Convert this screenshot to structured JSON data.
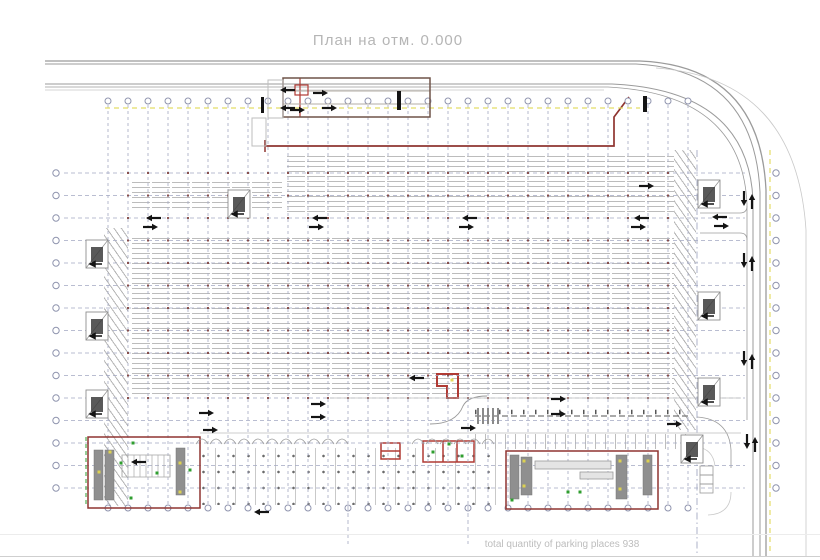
{
  "title": "План на отм. 0.000",
  "footer": "total quantity of parking places 938",
  "colors": {
    "grid": "#a3a8c2",
    "bubble": "#8f94ae",
    "road": "#9b9b9b",
    "road_faint": "#c9c9c9",
    "stall": "#bcbcbc",
    "red": "#8f3430",
    "red_bright": "#b03a34",
    "brown": "#6f5348",
    "yellow": "#e4dd67",
    "green": "#2f9e2f",
    "black": "#141414",
    "core": "#8f8f8f",
    "column_dot": "#7d3b36",
    "light": "#bdbdbd"
  },
  "plan": {
    "vgrid": {
      "x0": 108,
      "step": 20,
      "count": 30,
      "bubbleYTop": 101,
      "bubbleYBot": 508,
      "lineY0": 105,
      "lineY1": 504
    },
    "hgrid": {
      "y0": 173,
      "step": 22.5,
      "count": 15,
      "bubbleXLeft": 56,
      "bubbleXRight": 776,
      "lineX0": 64,
      "lineX1": 745
    },
    "fields": [
      {
        "x": 285,
        "y": 152,
        "w": 389,
        "h": 60,
        "t": "stalls"
      },
      {
        "x": 130,
        "y": 178,
        "w": 152,
        "h": 34,
        "t": "stalls"
      },
      {
        "x": 130,
        "y": 234,
        "w": 544,
        "h": 162,
        "t": "stalls"
      },
      {
        "x": 104,
        "y": 228,
        "w": 24,
        "h": 278,
        "t": "hatch"
      },
      {
        "x": 674,
        "y": 150,
        "w": 22,
        "h": 280,
        "t": "hatch"
      },
      {
        "x": 196,
        "y": 448,
        "w": 300,
        "h": 57,
        "t": "bike"
      },
      {
        "x": 475,
        "y": 434,
        "w": 213,
        "h": 15,
        "t": "vlines"
      }
    ],
    "paths": [
      {
        "d": "M45,61 H640 Q760,66 766,190 V556",
        "c": "#9b9b9b",
        "w": 1.3
      },
      {
        "d": "M45,64 H636 Q754,70 760,192 V556",
        "c": "#9b9b9b",
        "w": 1
      },
      {
        "d": "M45,84 H612 Q748,90 753,200 V556",
        "c": "#9b9b9b",
        "w": 1
      },
      {
        "d": "M45,87 H608 Q742,94 747,204 V420",
        "c": "#9b9b9b",
        "w": 0.8
      },
      {
        "d": "M45,90 H604",
        "c": "#c9c9c9",
        "w": 0.8
      },
      {
        "d": "M656,68 Q796,78 806,230 V556",
        "c": "#c9c9c9",
        "w": 0.8
      },
      {
        "d": "M697,417 Q729,419 731,450 V468",
        "c": "#9b9b9b",
        "w": 0.8
      },
      {
        "d": "M697,447 Q713,449 715,466",
        "c": "#c9c9c9",
        "w": 0.8
      },
      {
        "d": "M731,492 Q731,514 708,515",
        "c": "#c9c9c9",
        "w": 0.8
      },
      {
        "d": "M740,213 Q747,213 747,206",
        "c": "#9b9b9b",
        "w": 0.8
      },
      {
        "d": "M740,233 Q747,233 747,240",
        "c": "#9b9b9b",
        "w": 0.8
      },
      {
        "d": "M430,424 Q456,424 463,406 Q468,396 487,396",
        "c": "#999999",
        "w": 0.9
      },
      {
        "d": "M265,146 H614 V117 L629,97",
        "c": "#8f3430",
        "w": 1.7
      },
      {
        "d": "M265,140 V152",
        "c": "#8f3430",
        "w": 1.5
      },
      {
        "d": "M300,78 V117",
        "c": "#b03a34",
        "w": 1.2
      },
      {
        "d": "M437,374 h21 v24 h-11 v-12 h-10 z",
        "c": "#b03a34",
        "w": 2
      },
      {
        "d": "M423,441 h51 v21 h-51 z M443,441 v21 M457,441 v21",
        "c": "#b03a34",
        "w": 1.5
      },
      {
        "d": "M381,443 h19 v16 h-19 z M381,451 h19",
        "c": "#b03a34",
        "w": 1.5
      }
    ],
    "lines": [
      [
        700,
        213,
        740,
        213,
        "#9b9b9b",
        0.8,
        ""
      ],
      [
        700,
        233,
        740,
        233,
        "#9b9b9b",
        0.8,
        ""
      ],
      [
        330,
        398,
        741,
        398,
        "#bdbdbd",
        0.8,
        ""
      ],
      [
        200,
        433,
        741,
        433,
        "#bdbdbd",
        0.8,
        ""
      ],
      [
        283,
        91,
        430,
        91,
        "#b3aca4",
        0.9,
        ""
      ],
      [
        283,
        104,
        430,
        104,
        "#b3aca4",
        0.9,
        ""
      ],
      [
        105,
        108,
        640,
        108,
        "#e4dd67",
        1.2,
        "5 4"
      ],
      [
        770,
        150,
        770,
        554,
        "#e4dd67",
        1.2,
        "5 4"
      ],
      [
        86,
        437,
        86,
        507,
        "#2f9e2f",
        1,
        "4 3"
      ],
      [
        475,
        416,
        690,
        416,
        "#555555",
        1,
        "6 3"
      ],
      [
        475,
        412,
        690,
        412,
        "#555555",
        4.5,
        "1.5 10.5"
      ],
      [
        348,
        506,
        348,
        544,
        "#a3a8c2",
        0.8,
        "4 3"
      ],
      [
        468,
        506,
        468,
        544,
        "#a3a8c2",
        0.8,
        "4 3"
      ],
      [
        697,
        150,
        697,
        556,
        "#a3a8c2",
        0.9,
        "7 3 1.5 3"
      ]
    ],
    "rects": [
      {
        "x": 283,
        "y": 78,
        "w": 147,
        "h": 39,
        "c": "#6f5348",
        "sw": 1.5
      },
      {
        "x": 295,
        "y": 85,
        "w": 13,
        "h": 10,
        "c": "#b03a34",
        "sw": 1.2
      },
      {
        "x": 268,
        "y": 80,
        "w": 15,
        "h": 38,
        "c": "#bdbdbd",
        "sw": 1
      },
      {
        "x": 252,
        "y": 118,
        "w": 14,
        "h": 28,
        "c": "#bdbdbd",
        "sw": 1
      },
      {
        "x": 88,
        "y": 437,
        "w": 112,
        "h": 71,
        "c": "#8f3430",
        "sw": 1.5
      },
      {
        "x": 506,
        "y": 451,
        "w": 152,
        "h": 58,
        "c": "#8f3430",
        "sw": 1.5
      },
      {
        "x": 94,
        "y": 450,
        "w": 9,
        "h": 50,
        "c": "#777777",
        "f": "#8f8f8f",
        "sw": 0.5
      },
      {
        "x": 105,
        "y": 450,
        "w": 9,
        "h": 50,
        "c": "#777777",
        "f": "#8f8f8f",
        "sw": 0.5
      },
      {
        "x": 176,
        "y": 448,
        "w": 9,
        "h": 47,
        "c": "#777777",
        "f": "#8f8f8f",
        "sw": 0.5
      },
      {
        "x": 510,
        "y": 455,
        "w": 9,
        "h": 44,
        "c": "#777777",
        "f": "#8f8f8f",
        "sw": 0.5
      },
      {
        "x": 521,
        "y": 457,
        "w": 11,
        "h": 38,
        "c": "#777777",
        "f": "#8f8f8f",
        "sw": 0.5
      },
      {
        "x": 616,
        "y": 455,
        "w": 11,
        "h": 44,
        "c": "#777777",
        "f": "#8f8f8f",
        "sw": 0.5
      },
      {
        "x": 643,
        "y": 455,
        "w": 9,
        "h": 40,
        "c": "#777777",
        "f": "#8f8f8f",
        "sw": 0.5
      },
      {
        "x": 122,
        "y": 455,
        "w": 48,
        "h": 22,
        "c": "#aaaaaa",
        "sw": 0.8
      },
      {
        "x": 535,
        "y": 461,
        "w": 76,
        "h": 8,
        "c": "#9a9a9a",
        "f": "#e4e4e4",
        "sw": 0.8
      },
      {
        "x": 580,
        "y": 472,
        "w": 33,
        "h": 7,
        "c": "#9a9a9a",
        "f": "#e4e4e4",
        "sw": 0.8
      },
      {
        "x": 700,
        "y": 466,
        "w": 13,
        "h": 9,
        "c": "#9a9a9a",
        "sw": 0.8
      },
      {
        "x": 700,
        "y": 475,
        "w": 13,
        "h": 9,
        "c": "#9a9a9a",
        "sw": 0.8
      },
      {
        "x": 700,
        "y": 484,
        "w": 13,
        "h": 9,
        "c": "#9a9a9a",
        "sw": 0.8
      }
    ],
    "cores": [
      [
        86,
        240
      ],
      [
        86,
        312
      ],
      [
        86,
        390
      ],
      [
        228,
        190
      ],
      [
        698,
        180
      ],
      [
        698,
        292
      ],
      [
        698,
        378
      ],
      [
        681,
        435
      ]
    ],
    "core_size": {
      "w": 22,
      "h": 28
    },
    "arrows": [
      [
        152,
        218,
        "L"
      ],
      [
        152,
        227,
        "R"
      ],
      [
        318,
        218,
        "L"
      ],
      [
        318,
        227,
        "R"
      ],
      [
        468,
        218,
        "L"
      ],
      [
        468,
        227,
        "R"
      ],
      [
        640,
        218,
        "L"
      ],
      [
        640,
        227,
        "R"
      ],
      [
        286,
        90,
        "L"
      ],
      [
        286,
        108,
        "L"
      ],
      [
        299,
        110,
        "R"
      ],
      [
        322,
        93,
        "R"
      ],
      [
        331,
        108,
        "R"
      ],
      [
        208,
        413,
        "R"
      ],
      [
        212,
        430,
        "R"
      ],
      [
        320,
        404,
        "R"
      ],
      [
        320,
        417,
        "R"
      ],
      [
        470,
        428,
        "R"
      ],
      [
        560,
        399,
        "R"
      ],
      [
        560,
        414,
        "R"
      ],
      [
        676,
        424,
        "R"
      ],
      [
        744,
        200,
        "D"
      ],
      [
        752,
        200,
        "U"
      ],
      [
        744,
        262,
        "D"
      ],
      [
        752,
        262,
        "U"
      ],
      [
        744,
        360,
        "D"
      ],
      [
        752,
        360,
        "U"
      ],
      [
        747,
        443,
        "D"
      ],
      [
        755,
        443,
        "U"
      ],
      [
        718,
        217,
        "L"
      ],
      [
        723,
        226,
        "R"
      ],
      [
        415,
        378,
        "L"
      ],
      [
        260,
        512,
        "L"
      ],
      [
        648,
        186,
        "R"
      ],
      [
        137,
        462,
        "L"
      ]
    ],
    "bars": [
      [
        261,
        97,
        3,
        16
      ],
      [
        397,
        91,
        4,
        19
      ],
      [
        643,
        96,
        4,
        16
      ]
    ],
    "dots_green": [
      [
        121,
        463
      ],
      [
        131,
        498
      ],
      [
        157,
        473
      ],
      [
        133,
        443
      ],
      [
        568,
        492
      ],
      [
        580,
        492
      ],
      [
        512,
        500
      ],
      [
        433,
        452
      ],
      [
        449,
        444
      ],
      [
        462,
        456
      ],
      [
        190,
        470
      ]
    ],
    "dots_yellow": [
      [
        99,
        472
      ],
      [
        180,
        463
      ],
      [
        180,
        492
      ],
      [
        110,
        452
      ],
      [
        524,
        461
      ],
      [
        524,
        486
      ],
      [
        620,
        461
      ],
      [
        620,
        489
      ],
      [
        648,
        461
      ],
      [
        452,
        380
      ]
    ],
    "arcs": [
      {
        "x0": 202,
        "x1": 342,
        "y": 444,
        "r": 6,
        "step": 14
      },
      {
        "x0": 418,
        "x1": 488,
        "y": 444,
        "r": 6,
        "step": 14
      }
    ],
    "treads": {
      "x": 122,
      "y": 455,
      "h": 22,
      "n": 8,
      "dx": 6
    },
    "crosswalk": {
      "x": 477,
      "y": 408,
      "n": 5,
      "dx": 5,
      "w": 2,
      "h": 16,
      "c": "#8a8a8a"
    },
    "col_dots": {
      "y0": 173,
      "step": 22.5,
      "rows": 11,
      "xMin": 125,
      "xMax": 676,
      "size": 2
    }
  }
}
